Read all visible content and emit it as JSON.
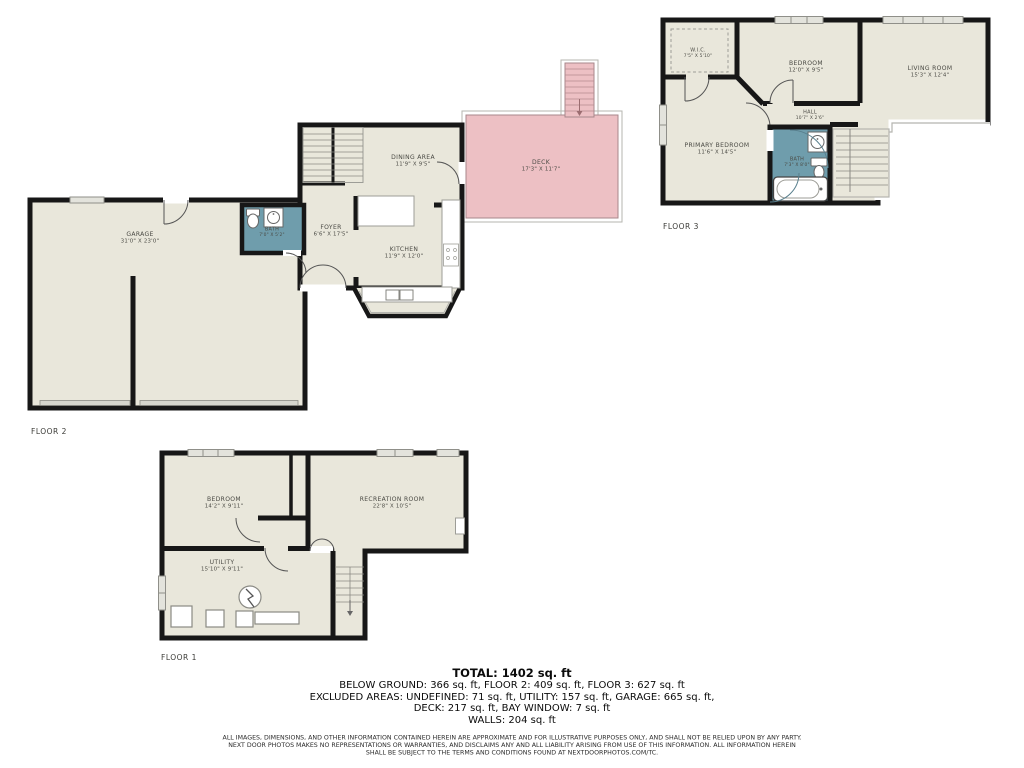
{
  "colors": {
    "floor_fill": "#e9e7db",
    "wall": "#171717",
    "bath_fill": "#6f9dac",
    "deck_fill": "#edc0c4",
    "fixture_stroke": "#8a8a84"
  },
  "floors": {
    "floor2": {
      "label": "FLOOR 2",
      "rooms": {
        "garage": {
          "name": "GARAGE",
          "dims": "31'0\" X 23'0\""
        },
        "bath": {
          "name": "BATH",
          "dims": "7'0\" X 5'2\""
        },
        "foyer": {
          "name": "FOYER",
          "dims": "6'6\" X 17'5\""
        },
        "dining": {
          "name": "DINING AREA",
          "dims": "11'9\" X 9'5\""
        },
        "kitchen": {
          "name": "KITCHEN",
          "dims": "11'9\" X 12'0\""
        },
        "deck": {
          "name": "DECK",
          "dims": "17'3\" X 11'7\""
        }
      }
    },
    "floor3": {
      "label": "FLOOR 3",
      "rooms": {
        "wic": {
          "name": "W.I.C.",
          "dims": "7'5\" X 5'10\""
        },
        "bedroom": {
          "name": "BEDROOM",
          "dims": "12'0\" X 9'5\""
        },
        "living": {
          "name": "LIVING ROOM",
          "dims": "15'3\" X 12'4\""
        },
        "hall": {
          "name": "HALL",
          "dims": "10'7\" X 2'6\""
        },
        "primary": {
          "name": "PRIMARY BEDROOM",
          "dims": "11'6\" X 14'5\""
        },
        "bath": {
          "name": "BATH",
          "dims": "7'3\" X 8'0\""
        }
      }
    },
    "floor1": {
      "label": "FLOOR 1",
      "rooms": {
        "bedroom": {
          "name": "BEDROOM",
          "dims": "14'2\" X 9'11\""
        },
        "recreation": {
          "name": "RECREATION ROOM",
          "dims": "22'8\" X 10'5\""
        },
        "utility": {
          "name": "UTILITY",
          "dims": "15'10\" X 9'11\""
        }
      }
    }
  },
  "summary": {
    "total": "TOTAL: 1402 sq. ft",
    "lines": [
      "BELOW GROUND: 366 sq. ft, FLOOR 2: 409 sq. ft, FLOOR 3: 627 sq. ft",
      "EXCLUDED AREAS: UNDEFINED: 71 sq. ft, UTILITY: 157 sq. ft, GARAGE: 665 sq. ft,",
      "DECK: 217 sq. ft, BAY WINDOW: 7 sq. ft",
      "WALLS: 204 sq. ft"
    ]
  },
  "disclaimer": [
    "ALL IMAGES, DIMENSIONS, AND OTHER INFORMATION CONTAINED HEREIN ARE APPROXIMATE AND FOR ILLUSTRATIVE PURPOSES ONLY, AND SHALL NOT BE RELIED UPON BY ANY PARTY.",
    "NEXT DOOR PHOTOS MAKES NO REPRESENTATIONS OR WARRANTIES, AND DISCLAIMS ANY AND ALL LIABILITY ARISING FROM USE OF THIS INFORMATION. ALL INFORMATION HEREIN",
    "SHALL BE SUBJECT TO THE TERMS AND CONDITIONS FOUND AT NEXTDOORPHOTOS.COM/TC."
  ]
}
